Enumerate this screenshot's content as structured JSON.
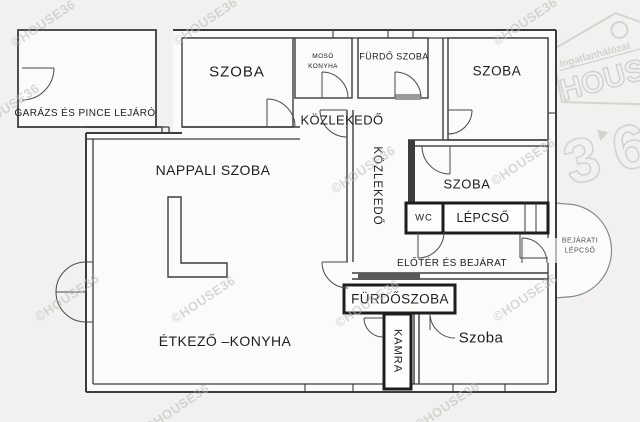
{
  "watermark": {
    "text": "©HOUSE36",
    "logo": {
      "brand_small": "Ingatlanhálózat",
      "brand_large": "HOUSE",
      "digit_left": "3",
      "digit_right": "6"
    }
  },
  "rooms": {
    "garage": "GARÁZS ÉS PINCE LEJÁRÓ",
    "szoba_top_left": "SZOBA",
    "moso_konyha_line1": "MOSÓ",
    "moso_konyha_line2": "KONYHA",
    "furdo_szoba": "FÜRDŐ SZOBA",
    "szoba_top_right": "SZOBA",
    "kozlekedo_horizontal": "KÖZLEKEDŐ",
    "kozlekedo_vertical": "KÖZLEKEDŐ",
    "nappali_szoba": "NAPPALI SZOBA",
    "szoba_middle": "SZOBA",
    "wc": "WC",
    "lepcso": "LÉPCSŐ",
    "bejarati_lepcso_line1": "BEJÁRATI",
    "bejarati_lepcso_line2": "LÉPCSŐ",
    "eloter_es_bejarat": "ELŐTÉR ÉS BEJÁRAT",
    "furdoszoba": "FÜRDŐSZOBA",
    "kamra": "KAMRA",
    "etkezo_konyha": "ÉTKEZŐ –KONYHA",
    "szoba_bottom": "Szoba"
  },
  "colors": {
    "wall": "#3c3c3c",
    "background": "#f2f1ef",
    "room_fill": "#fbfbfa",
    "watermark": "#bdbbb8",
    "threshold": "#5a5a5a"
  }
}
